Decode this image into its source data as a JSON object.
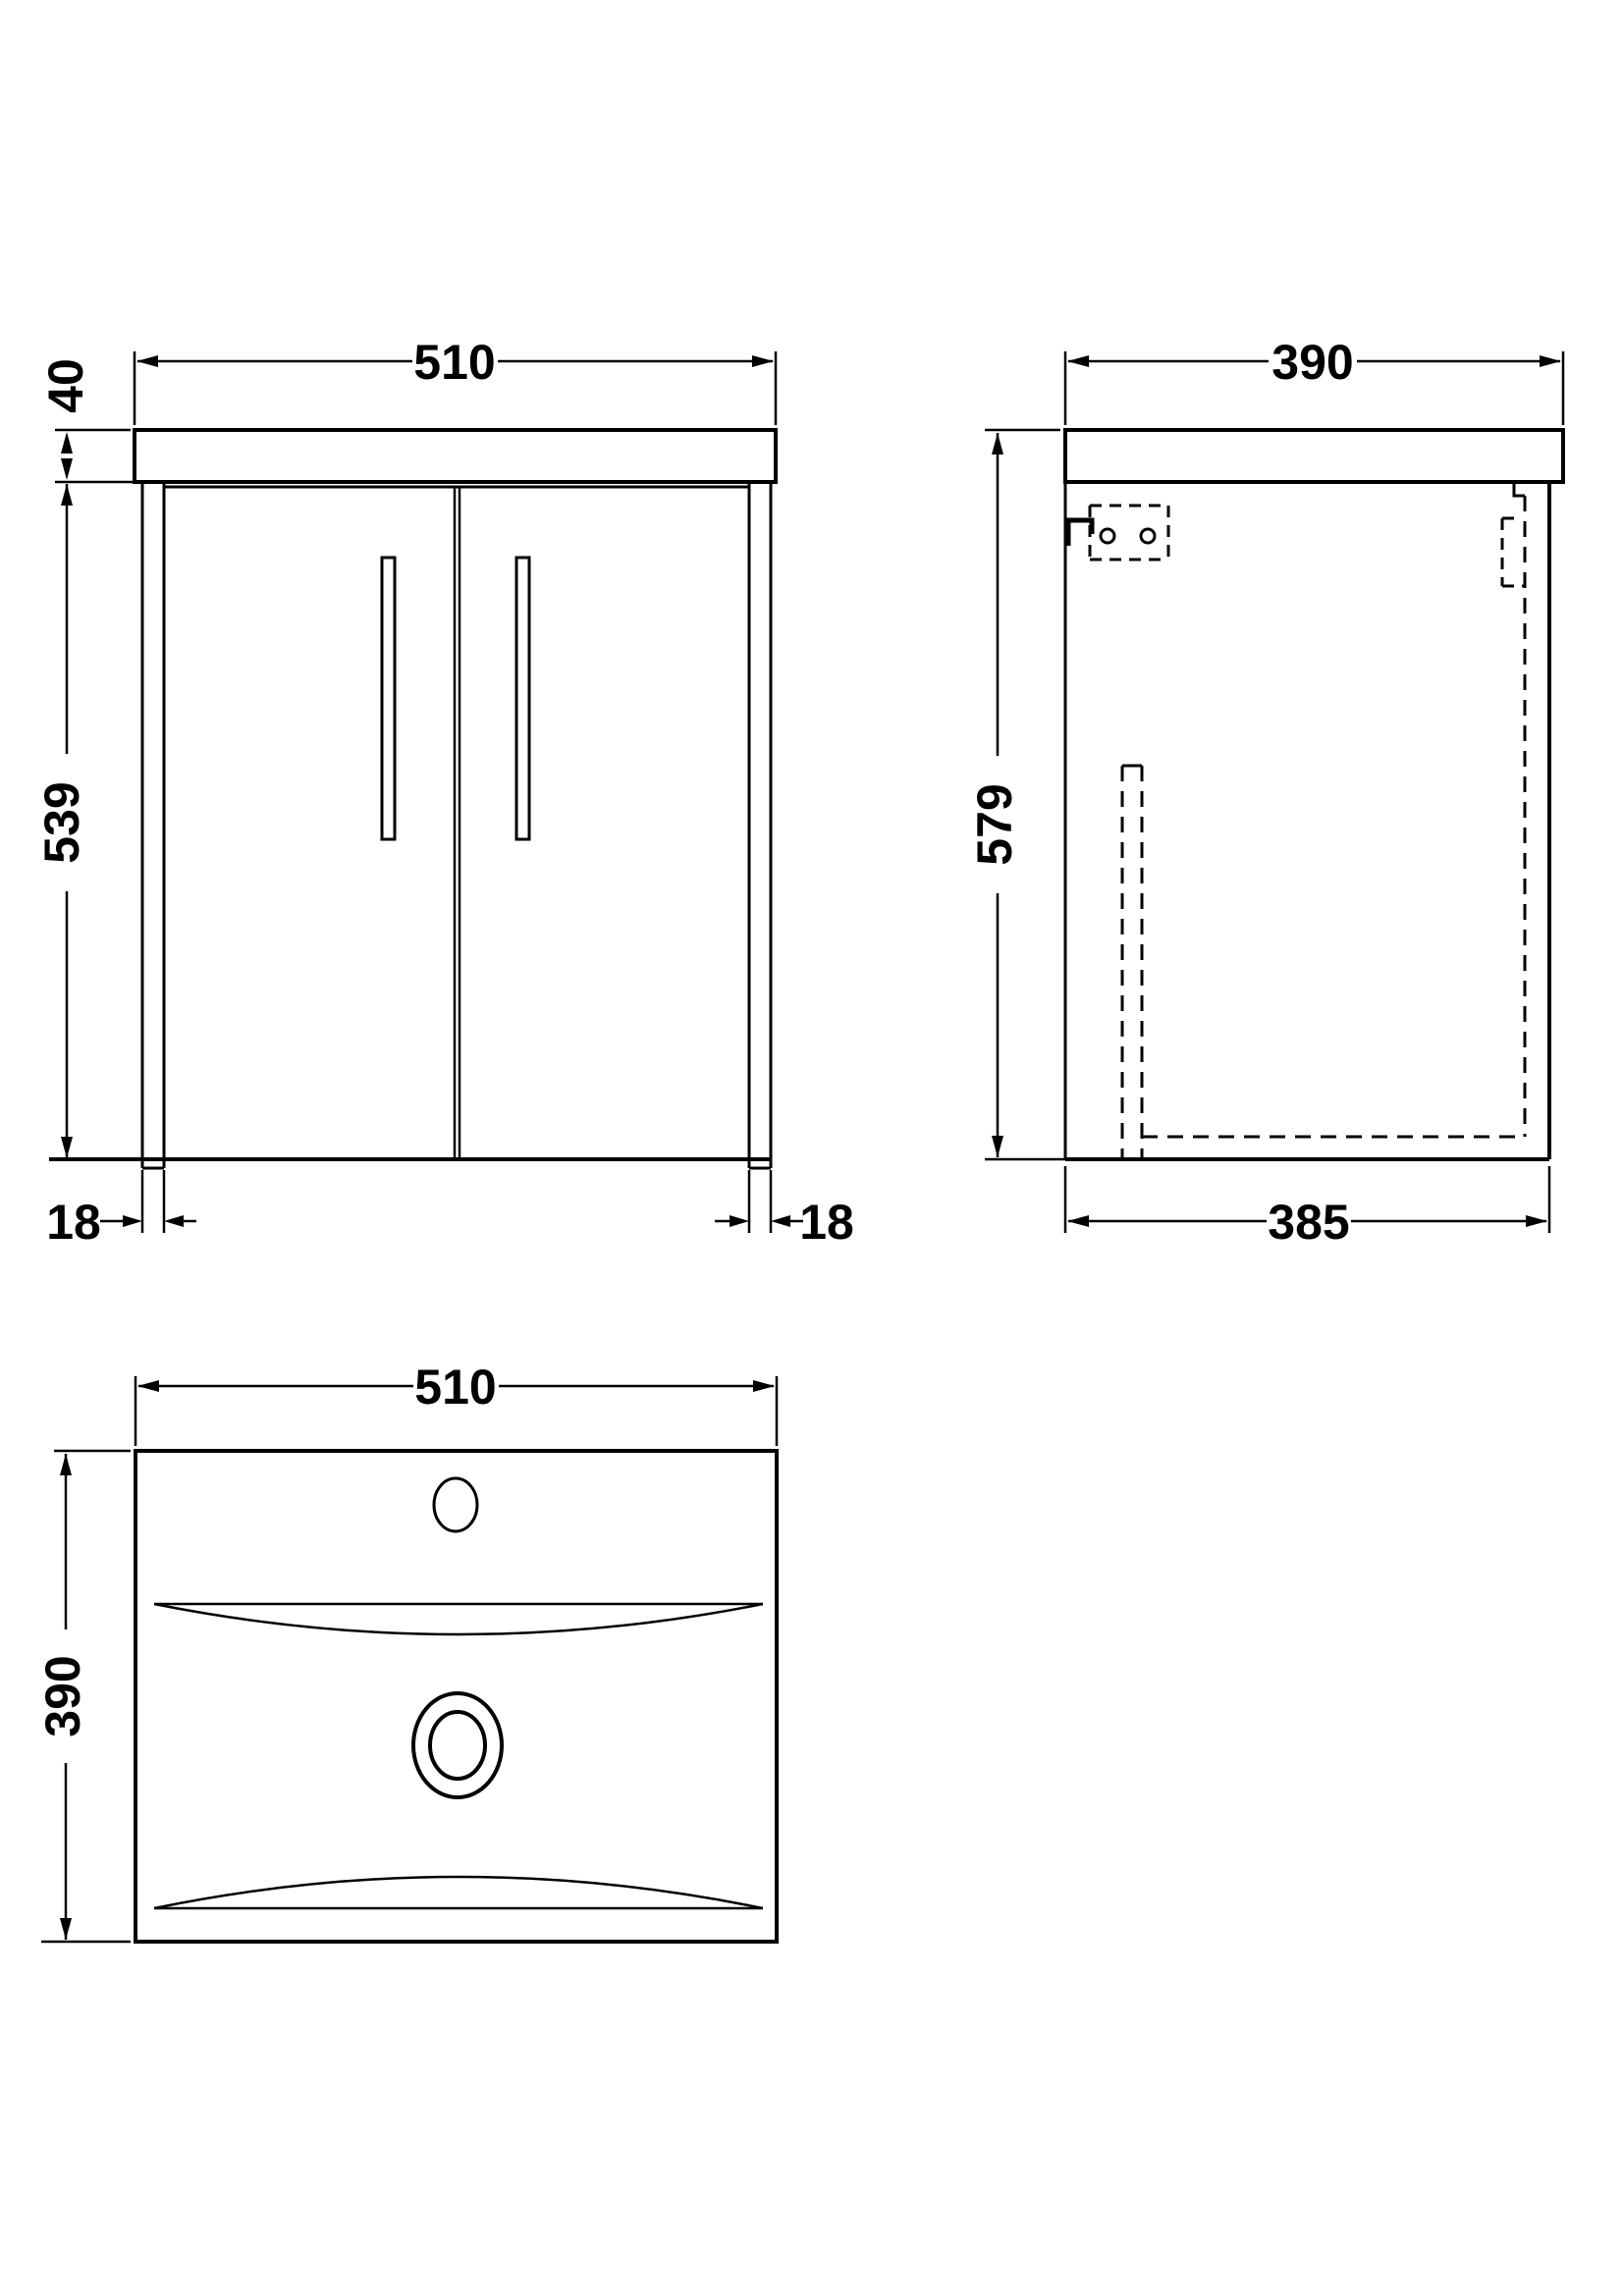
{
  "drawing": {
    "title": "vanity-unit-technical-drawing",
    "background_color": "#ffffff",
    "line_color": "#000000",
    "views": {
      "front": {
        "label": "front-elevation",
        "dims": {
          "width": "510",
          "worktop_thickness": "40",
          "body_height": "539",
          "left_side_thickness": "18",
          "right_side_thickness": "18"
        }
      },
      "side": {
        "label": "side-elevation",
        "dims": {
          "depth": "390",
          "overall_height": "579",
          "body_depth": "385"
        }
      },
      "plan": {
        "label": "basin-plan",
        "dims": {
          "width": "510",
          "depth": "390"
        }
      }
    }
  }
}
